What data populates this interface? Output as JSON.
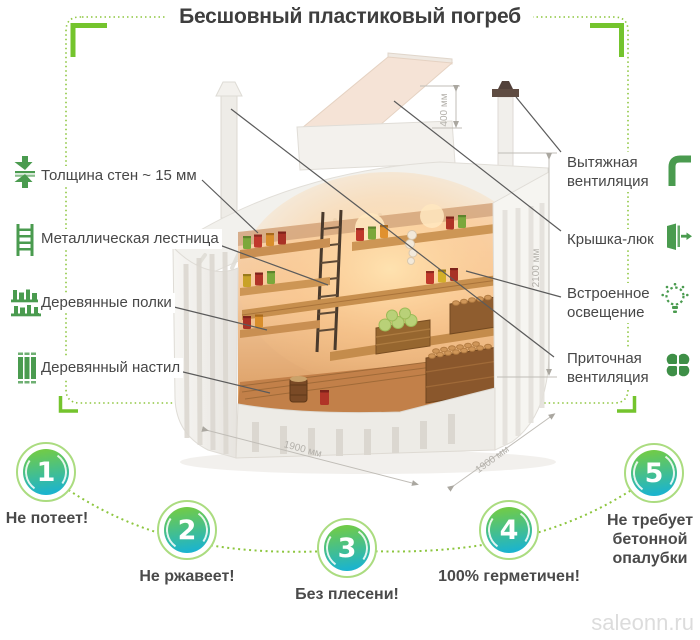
{
  "title": "Бесшовный пластиковый погреб",
  "watermark": "saleonn.ru",
  "accent": {
    "bracket_green": "#74c42d",
    "dotted_green": "#8dc63f",
    "icon_green": "#4a9b4f",
    "circle_gradient_top": "#70cb49",
    "circle_gradient_bottom": "#1cb4cd",
    "circle_ring": "#abdc80"
  },
  "left_labels": [
    {
      "icon": "wall-thickness-icon",
      "label": "Толщина стен ~ 15 мм"
    },
    {
      "icon": "ladder-icon",
      "label": "Металлическая лестница"
    },
    {
      "icon": "shelves-icon",
      "label": "Деревянные полки"
    },
    {
      "icon": "flooring-icon",
      "label": "Деревянный настил"
    }
  ],
  "right_labels": [
    {
      "icon": "exhaust-vent-icon",
      "label": "Вытяжная вентиляция"
    },
    {
      "icon": "hatch-icon",
      "label": "Крышка-люк"
    },
    {
      "icon": "light-icon",
      "label": "Встроенное освещение"
    },
    {
      "icon": "supply-vent-icon",
      "label": "Приточная вентиляция"
    }
  ],
  "dims": {
    "collar": "400 мм",
    "height": "2100 мм",
    "w_left": "1900 мм",
    "w_right": "1900 мм"
  },
  "benefits": [
    {
      "number": "1",
      "label": "Не потеет!"
    },
    {
      "number": "2",
      "label": "Не ржавеет!"
    },
    {
      "number": "3",
      "label": "Без плесени!"
    },
    {
      "number": "4",
      "label": "100% герметичен!"
    },
    {
      "number": "5",
      "label": "Не требует бетонной опалубки"
    }
  ]
}
